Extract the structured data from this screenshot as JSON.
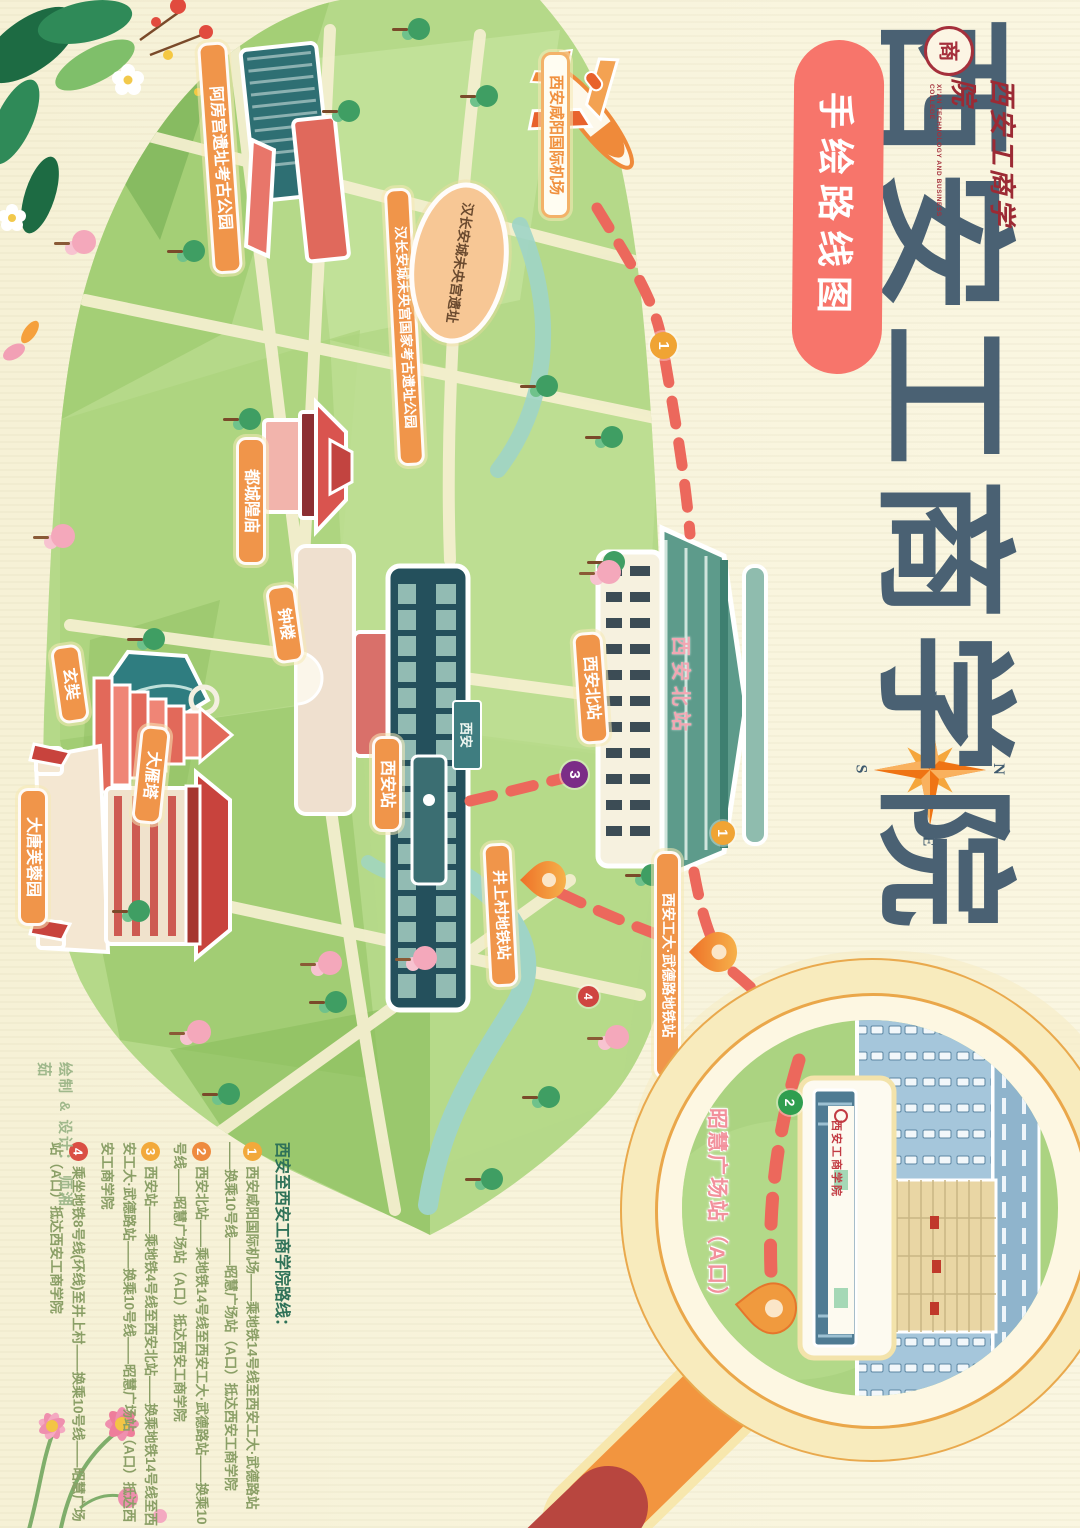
{
  "title": {
    "chars": "西安工商学院",
    "badge": "手绘路线图"
  },
  "logo": {
    "seal_char": "商",
    "name": "西安工商学院",
    "english": "XI'AN TECHNOLOGY AND BUSINESS COLLEGE"
  },
  "compass": {
    "n": "N",
    "s": "S",
    "e": "E",
    "w": "W"
  },
  "colors": {
    "accent_pink": "#f7756b",
    "label_orange": "#f0954a",
    "route_dash": "#ec685c",
    "map_green": "#b5d989",
    "title_slate": "#4a6173"
  },
  "landmarks": {
    "airport": {
      "label": "西安咸阳国际机场"
    },
    "afanggong": {
      "label": "阿房宫遗址考古公园"
    },
    "weiyang_park": {
      "label": "汉长安城未央宫国家考古遗址公园"
    },
    "weiyang_site": {
      "label": "汉长安城未央宫遗址"
    },
    "chenghuang": {
      "label": "都城隍庙"
    },
    "bell_tower": {
      "label": "钟楼"
    },
    "xuanzang": {
      "label": "玄奘"
    },
    "dayan_pagoda": {
      "label": "大雁塔"
    },
    "datang": {
      "label": "大唐芙蓉园"
    },
    "xian_station": {
      "label": "西安站",
      "sign": "西安"
    },
    "north_station": {
      "label": "西安北站",
      "roof_label": "西安北站"
    },
    "jingshangcun": {
      "label": "井上村地铁站"
    },
    "wudelu": {
      "label": "西安工大·武德路地铁站"
    },
    "zhaohui": {
      "label": "昭慧广场站（A口）"
    }
  },
  "magnifier": {
    "college_sign": "西安工商学院"
  },
  "map_markers": {
    "m1a": "1",
    "m3": "3",
    "m1b": "1",
    "m4": "4",
    "m2": "2"
  },
  "legend": {
    "header": "西安至西安工商学院路线：",
    "routes": [
      {
        "num": "1",
        "color": "#f2a93b",
        "text": "西安咸阳国际机场——乘地铁14号线至西安工大·武德路站——换乘10号线——昭慧广场站（A口）抵达西安工商学院"
      },
      {
        "num": "2",
        "color": "#ee8b3f",
        "text": "西安北站——乘地铁14号线至西安工大·武德路站——换乘10号线——昭慧广场站（A口）抵达西安工商学院"
      },
      {
        "num": "3",
        "color": "#f2a93b",
        "text": "西安站——乘地铁4号线至西安北站——换乘地铁14号线至西安工大·武德路站——换乘10号线——昭慧广场站（A口）抵达西安工商学院"
      },
      {
        "num": "4",
        "color": "#da4f44",
        "text": "乘坐地铁8号线(环线)至井上村——换乘10号线——昭慧广场站（A口）抵达西安工商学院"
      }
    ]
  },
  "credit": "绘制 & 设计： 师湘茹"
}
